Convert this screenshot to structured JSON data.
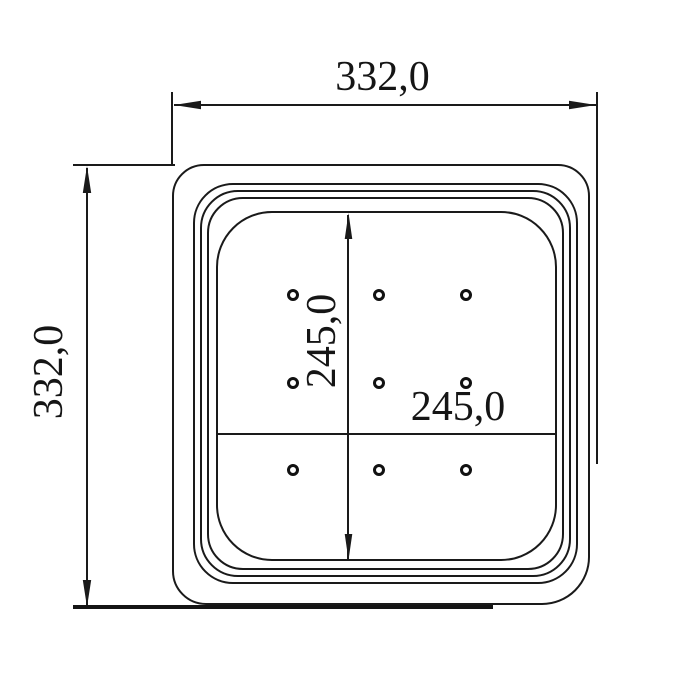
{
  "drawing": {
    "type": "technical-dimension-drawing",
    "background_color": "#ffffff",
    "line_color": "#1a1a1a",
    "dimensions": {
      "overall_width_label": "332,0",
      "overall_height_label": "332,0",
      "hole_field_height_label": "245,0",
      "hole_field_width_label": "245,0"
    },
    "holes": {
      "count": 9,
      "columns_x": [
        293,
        379,
        466
      ],
      "rows_y": [
        295,
        383,
        470
      ],
      "outer_diameter_px": 12
    }
  }
}
